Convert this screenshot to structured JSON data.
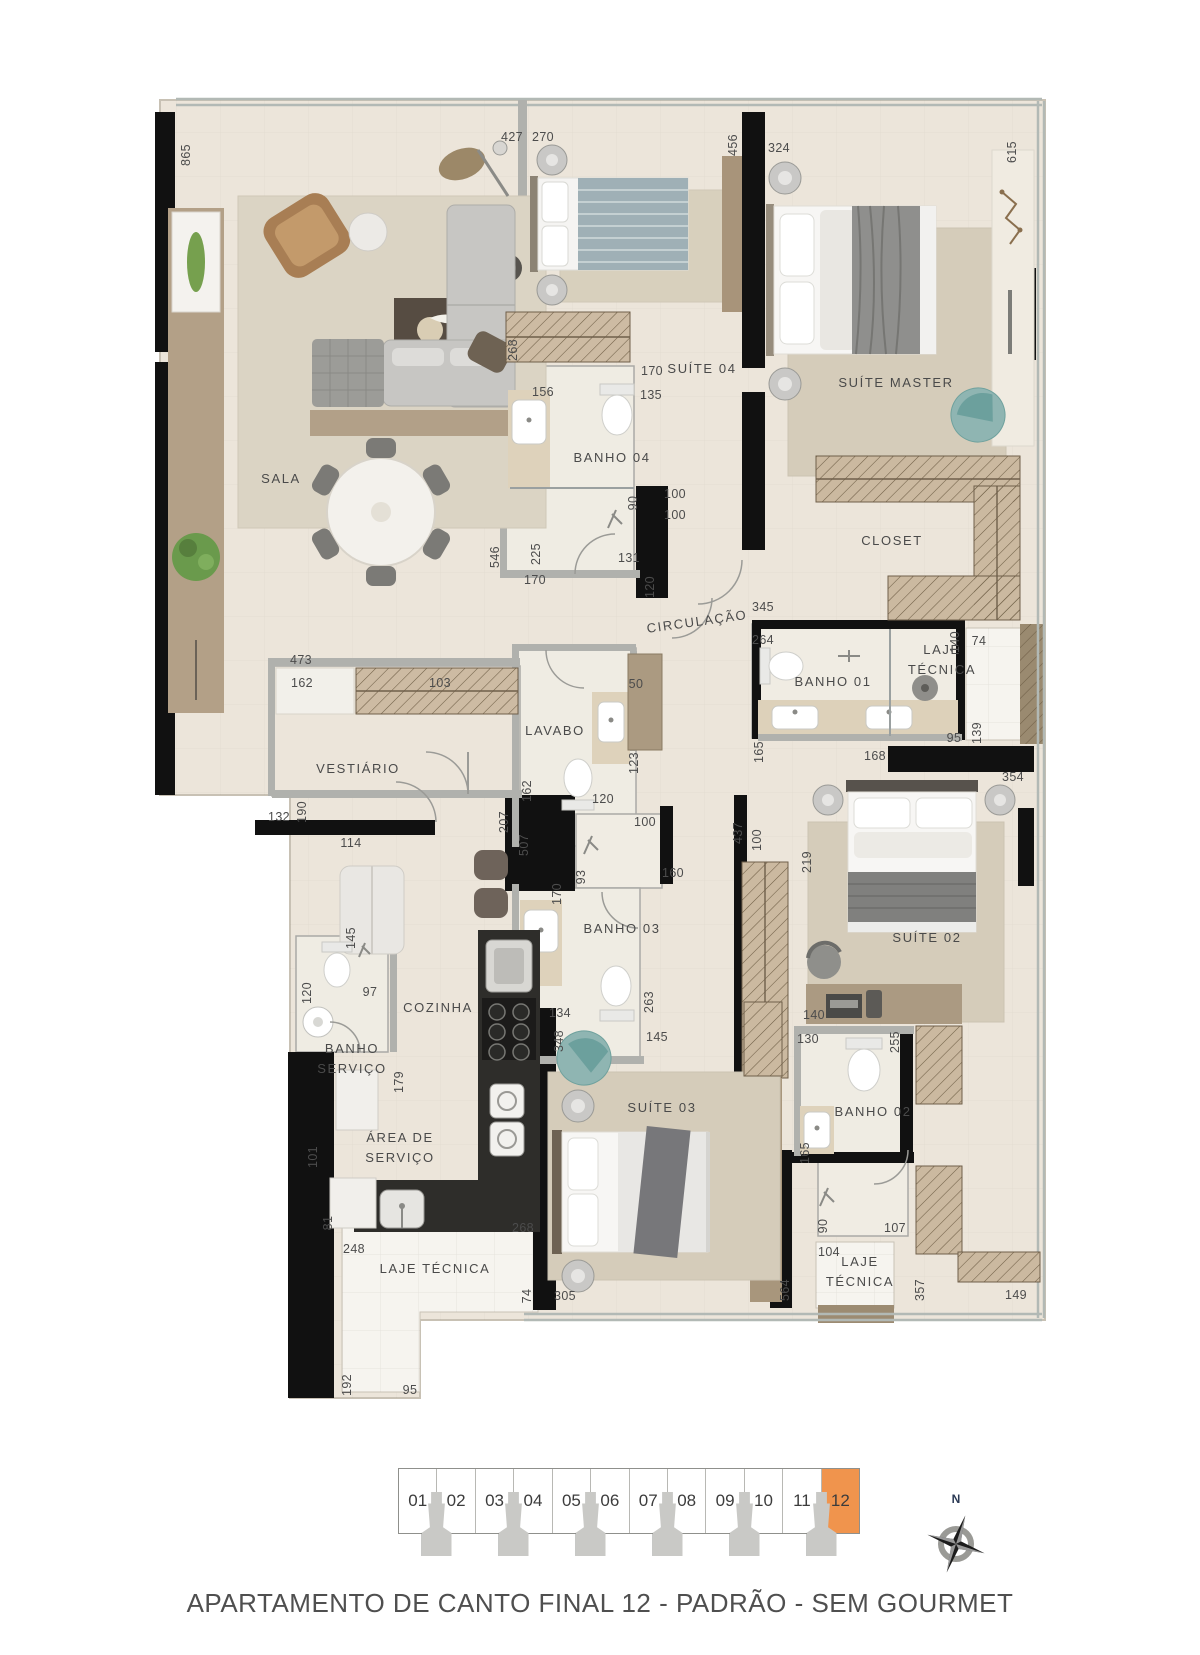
{
  "title": "APARTAMENTO DE CANTO FINAL 12 - PADRÃO - SEM GOURMET",
  "compass": {
    "north_label": "N"
  },
  "units": {
    "items": [
      "01",
      "02",
      "03",
      "04",
      "05",
      "06",
      "07",
      "08",
      "09",
      "10",
      "11",
      "12"
    ],
    "active": "12",
    "active_color": "#F0944D"
  },
  "plan": {
    "rooms": [
      {
        "name": "SALA",
        "x": 281,
        "y": 479
      },
      {
        "name": "SUÍTE 04",
        "x": 702,
        "y": 369
      },
      {
        "name": "BANHO  04",
        "x": 612,
        "y": 458
      },
      {
        "name": "SUÍTE MASTER",
        "x": 896,
        "y": 383
      },
      {
        "name": "CLOSET",
        "x": 892,
        "y": 541
      },
      {
        "name": "CIRCULAÇÃO",
        "x": 697,
        "y": 622,
        "rot": true
      },
      {
        "name": "BANHO  01",
        "x": 833,
        "y": 682
      },
      {
        "name": "LAJE\nTÉCNICA",
        "x": 942,
        "y": 660
      },
      {
        "name": "VESTIÁRIO",
        "x": 358,
        "y": 769
      },
      {
        "name": "LAVABO",
        "x": 555,
        "y": 731
      },
      {
        "name": "BANHO  03",
        "x": 622,
        "y": 929
      },
      {
        "name": "COZINHA",
        "x": 438,
        "y": 1008
      },
      {
        "name": "BANHO\nSERVIÇO",
        "x": 352,
        "y": 1059
      },
      {
        "name": "ÁREA DE\nSERVIÇO",
        "x": 400,
        "y": 1148
      },
      {
        "name": "SUÍTE 03",
        "x": 662,
        "y": 1108
      },
      {
        "name": "SUÍTE 02",
        "x": 927,
        "y": 938
      },
      {
        "name": "BANHO  02",
        "x": 873,
        "y": 1112
      },
      {
        "name": "LAJE\nTÉCNICA",
        "x": 860,
        "y": 1272
      },
      {
        "name": "LAJE TÉCNICA",
        "x": 435,
        "y": 1269
      }
    ],
    "dimensions": [
      {
        "t": "865",
        "x": 186,
        "y": 155,
        "v": true
      },
      {
        "t": "427",
        "x": 512,
        "y": 137
      },
      {
        "t": "270",
        "x": 543,
        "y": 137
      },
      {
        "t": "456",
        "x": 733,
        "y": 145,
        "v": true
      },
      {
        "t": "324",
        "x": 779,
        "y": 148
      },
      {
        "t": "615",
        "x": 1012,
        "y": 152,
        "v": true
      },
      {
        "t": "268",
        "x": 513,
        "y": 350,
        "v": true
      },
      {
        "t": "170",
        "x": 652,
        "y": 371
      },
      {
        "t": "156",
        "x": 543,
        "y": 392
      },
      {
        "t": "135",
        "x": 651,
        "y": 395
      },
      {
        "t": "100",
        "x": 675,
        "y": 494
      },
      {
        "t": "100",
        "x": 675,
        "y": 515
      },
      {
        "t": "90",
        "x": 633,
        "y": 503,
        "v": true
      },
      {
        "t": "546",
        "x": 495,
        "y": 557,
        "v": true
      },
      {
        "t": "225",
        "x": 536,
        "y": 554,
        "v": true
      },
      {
        "t": "131",
        "x": 629,
        "y": 558
      },
      {
        "t": "170",
        "x": 535,
        "y": 580
      },
      {
        "t": "120",
        "x": 650,
        "y": 587,
        "v": true
      },
      {
        "t": "345",
        "x": 763,
        "y": 607
      },
      {
        "t": "264",
        "x": 763,
        "y": 640
      },
      {
        "t": "140",
        "x": 955,
        "y": 642,
        "v": true
      },
      {
        "t": "74",
        "x": 979,
        "y": 641
      },
      {
        "t": "95",
        "x": 954,
        "y": 738
      },
      {
        "t": "139",
        "x": 977,
        "y": 733,
        "v": true
      },
      {
        "t": "165",
        "x": 759,
        "y": 752,
        "v": true
      },
      {
        "t": "168",
        "x": 875,
        "y": 756
      },
      {
        "t": "473",
        "x": 301,
        "y": 660
      },
      {
        "t": "162",
        "x": 302,
        "y": 683
      },
      {
        "t": "103",
        "x": 440,
        "y": 683
      },
      {
        "t": "132",
        "x": 279,
        "y": 817
      },
      {
        "t": "190",
        "x": 302,
        "y": 812,
        "v": true
      },
      {
        "t": "114",
        "x": 351,
        "y": 843
      },
      {
        "t": "145",
        "x": 351,
        "y": 938,
        "v": true
      },
      {
        "t": "120",
        "x": 307,
        "y": 993,
        "v": true
      },
      {
        "t": "97",
        "x": 370,
        "y": 992
      },
      {
        "t": "179",
        "x": 399,
        "y": 1082,
        "v": true
      },
      {
        "t": "207",
        "x": 504,
        "y": 822,
        "v": true
      },
      {
        "t": "507",
        "x": 524,
        "y": 845,
        "v": true
      },
      {
        "t": "162",
        "x": 527,
        "y": 791,
        "v": true
      },
      {
        "t": "120",
        "x": 603,
        "y": 799
      },
      {
        "t": "50",
        "x": 636,
        "y": 684
      },
      {
        "t": "123",
        "x": 634,
        "y": 763,
        "v": true
      },
      {
        "t": "100",
        "x": 645,
        "y": 822
      },
      {
        "t": "93",
        "x": 581,
        "y": 877,
        "v": true
      },
      {
        "t": "160",
        "x": 673,
        "y": 873
      },
      {
        "t": "170",
        "x": 557,
        "y": 894,
        "v": true
      },
      {
        "t": "134",
        "x": 560,
        "y": 1013
      },
      {
        "t": "263",
        "x": 649,
        "y": 1002,
        "v": true
      },
      {
        "t": "145",
        "x": 657,
        "y": 1037
      },
      {
        "t": "348",
        "x": 559,
        "y": 1041,
        "v": true
      },
      {
        "t": "437",
        "x": 738,
        "y": 833,
        "v": true
      },
      {
        "t": "100",
        "x": 757,
        "y": 840,
        "v": true
      },
      {
        "t": "219",
        "x": 807,
        "y": 862,
        "v": true
      },
      {
        "t": "354",
        "x": 1013,
        "y": 777
      },
      {
        "t": "140",
        "x": 814,
        "y": 1015
      },
      {
        "t": "130",
        "x": 808,
        "y": 1039
      },
      {
        "t": "255",
        "x": 895,
        "y": 1042,
        "v": true
      },
      {
        "t": "165",
        "x": 805,
        "y": 1153,
        "v": true
      },
      {
        "t": "90",
        "x": 823,
        "y": 1226,
        "v": true
      },
      {
        "t": "107",
        "x": 895,
        "y": 1228
      },
      {
        "t": "104",
        "x": 829,
        "y": 1252
      },
      {
        "t": "564",
        "x": 785,
        "y": 1290,
        "v": true
      },
      {
        "t": "357",
        "x": 920,
        "y": 1290,
        "v": true
      },
      {
        "t": "149",
        "x": 1016,
        "y": 1295
      },
      {
        "t": "101",
        "x": 313,
        "y": 1157,
        "v": true
      },
      {
        "t": "81",
        "x": 328,
        "y": 1223,
        "v": true
      },
      {
        "t": "268",
        "x": 523,
        "y": 1228
      },
      {
        "t": "248",
        "x": 354,
        "y": 1249
      },
      {
        "t": "74",
        "x": 527,
        "y": 1296,
        "v": true
      },
      {
        "t": "305",
        "x": 565,
        "y": 1296
      },
      {
        "t": "192",
        "x": 347,
        "y": 1385,
        "v": true
      },
      {
        "t": "95",
        "x": 410,
        "y": 1390
      }
    ]
  }
}
